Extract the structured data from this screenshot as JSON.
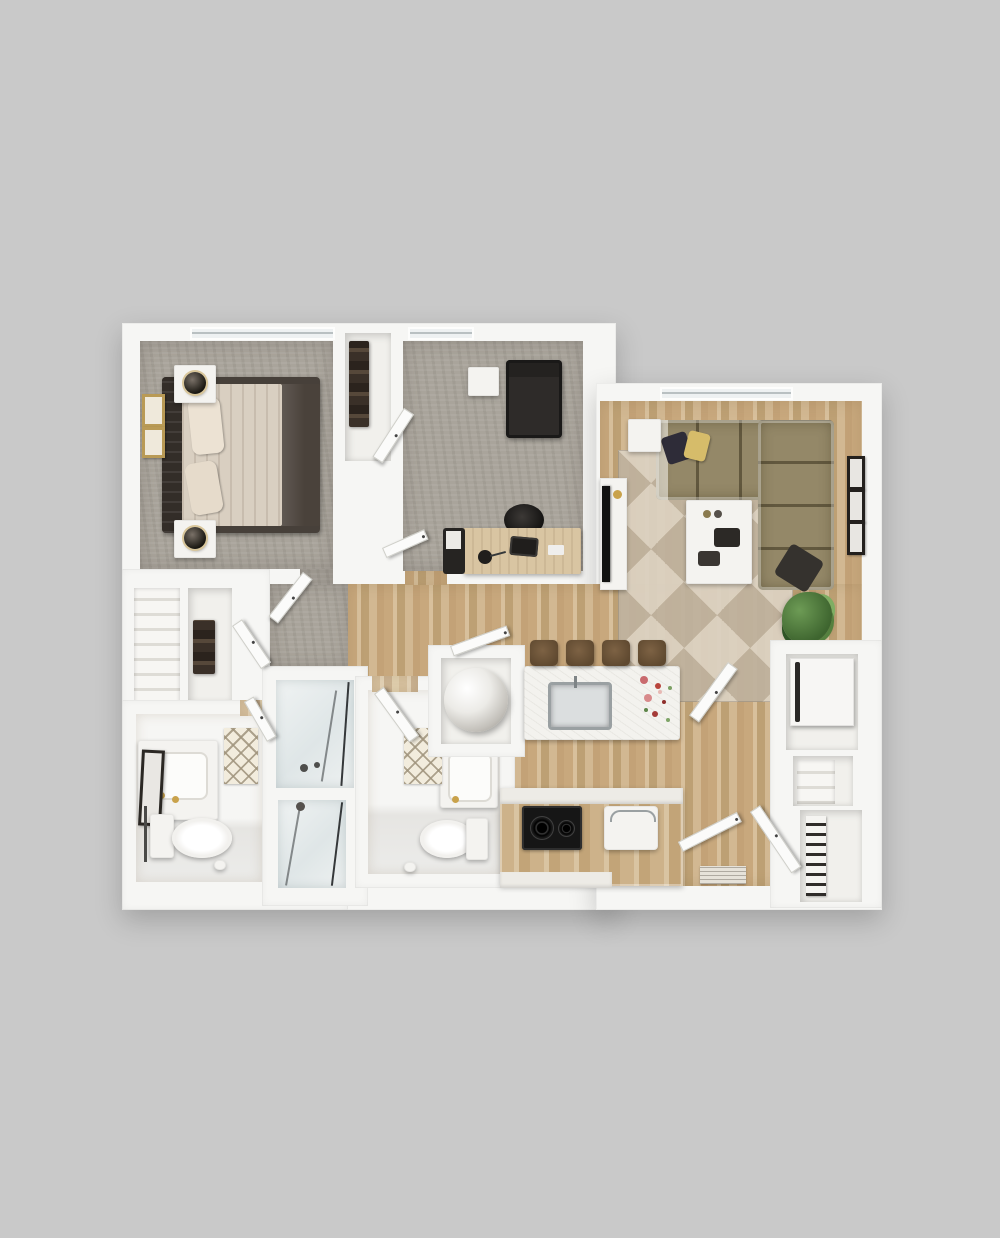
{
  "scene": {
    "kind": "3d-floor-plan-top-down-render",
    "background": "#c9c9c9",
    "no_visible_text": true
  },
  "palette": {
    "bg": "#c9c9c9",
    "wall": "#f6f6f4",
    "carpet": "#a9a49b",
    "wood_a": "#c8a87d",
    "wood_b": "#d8c09c",
    "woodlight_a": "#d6c09e",
    "woodlight_b": "#e4d4b8",
    "sofa": "#948868",
    "rug_a": "#dcd2c2",
    "rug_b": "#bfb29e",
    "dark": "#201e1c",
    "white_obj": "#f4f3f0",
    "stool": "#5f4930",
    "green_a": "#3e652f",
    "green_b": "#6d9b55"
  },
  "rooms": [
    {
      "id": "bedroom",
      "floor": "carpet",
      "furniture": [
        "bed",
        "headboard",
        "pillows",
        "nightstand-with-lamp-top",
        "nightstand-with-lamp-bottom",
        "wall-art-frames",
        "window",
        "reach-in-closet",
        "linen-closet",
        "walk-in-closet"
      ]
    },
    {
      "id": "office-den",
      "floor": "carpet",
      "furniture": [
        "lounge-chair",
        "side-table",
        "desk",
        "office-chair",
        "laptop",
        "desk-lamp",
        "file-cabinet",
        "window",
        "wardrobe-closet"
      ]
    },
    {
      "id": "living-room",
      "floor": "wood",
      "furniture": [
        "sectional-sofa",
        "throw-pillows",
        "coffee-table",
        "end-table",
        "tv-console",
        "tv",
        "area-rug",
        "potted-plant",
        "wall-art-frames",
        "window"
      ]
    },
    {
      "id": "kitchen",
      "floor": "wood",
      "furniture": [
        "island",
        "island-sink",
        "flower-bouquet",
        "bar-stools-x4",
        "cooktop",
        "base-cabinets",
        "countertop-appliance"
      ]
    },
    {
      "id": "hallway-entry",
      "floor": "wood",
      "furniture": [
        "doormat",
        "entry-doors"
      ]
    },
    {
      "id": "bathroom-1",
      "floor": "wood-light",
      "furniture": [
        "vanity-sink",
        "mirror",
        "toilet",
        "bath-mat",
        "towel-bar",
        "toilet-paper"
      ]
    },
    {
      "id": "bathroom-2",
      "floor": "wood-light",
      "furniture": [
        "vanity-sink",
        "toilet",
        "bath-mat",
        "toilet-paper"
      ]
    },
    {
      "id": "shower-rooms",
      "floor": "glass",
      "furniture": [
        "glass-shower-upper",
        "glass-shower-lower",
        "shower-fixtures"
      ]
    },
    {
      "id": "utility-closet",
      "floor": "white",
      "furniture": [
        "water-heater"
      ]
    },
    {
      "id": "storage-closets-right",
      "floor": "white",
      "furniture": [
        "washer-dryer",
        "shelf-unit",
        "towel-shelves",
        "closet-doors"
      ]
    }
  ]
}
